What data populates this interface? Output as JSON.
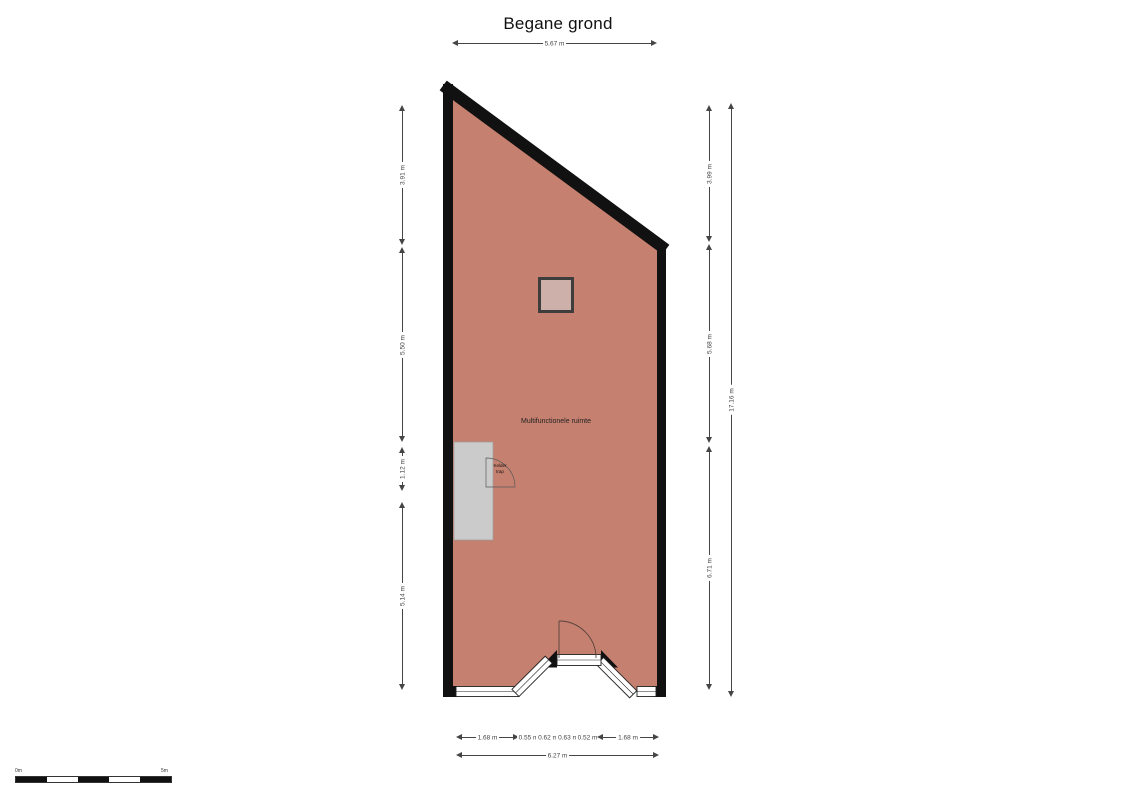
{
  "title": "Begane grond",
  "plan": {
    "room_label": "Multifunctionele ruimte",
    "stairs_label_line1": "Kelder",
    "stairs_label_line2": "trap"
  },
  "dimensions": {
    "top": "5.67 m",
    "left": [
      "3.91 m",
      "5.50 m",
      "1.12 m",
      "5.14 m"
    ],
    "right": [
      "3.99 m",
      "5.68 m",
      "6.71 m"
    ],
    "right_total": "17.16 m",
    "bottom": [
      "1.68 m",
      "0.55 m",
      "0.62 m",
      "0.63 m",
      "0.52 m",
      "1.68 m"
    ],
    "bottom_total": "6.27 m"
  },
  "scale_bar": {
    "start": "0m",
    "end": "5m"
  },
  "colors": {
    "floor": "#c6806f",
    "wall": "#111111",
    "skylight": "#cdb0a9",
    "stairs": "#cbcbcb"
  }
}
